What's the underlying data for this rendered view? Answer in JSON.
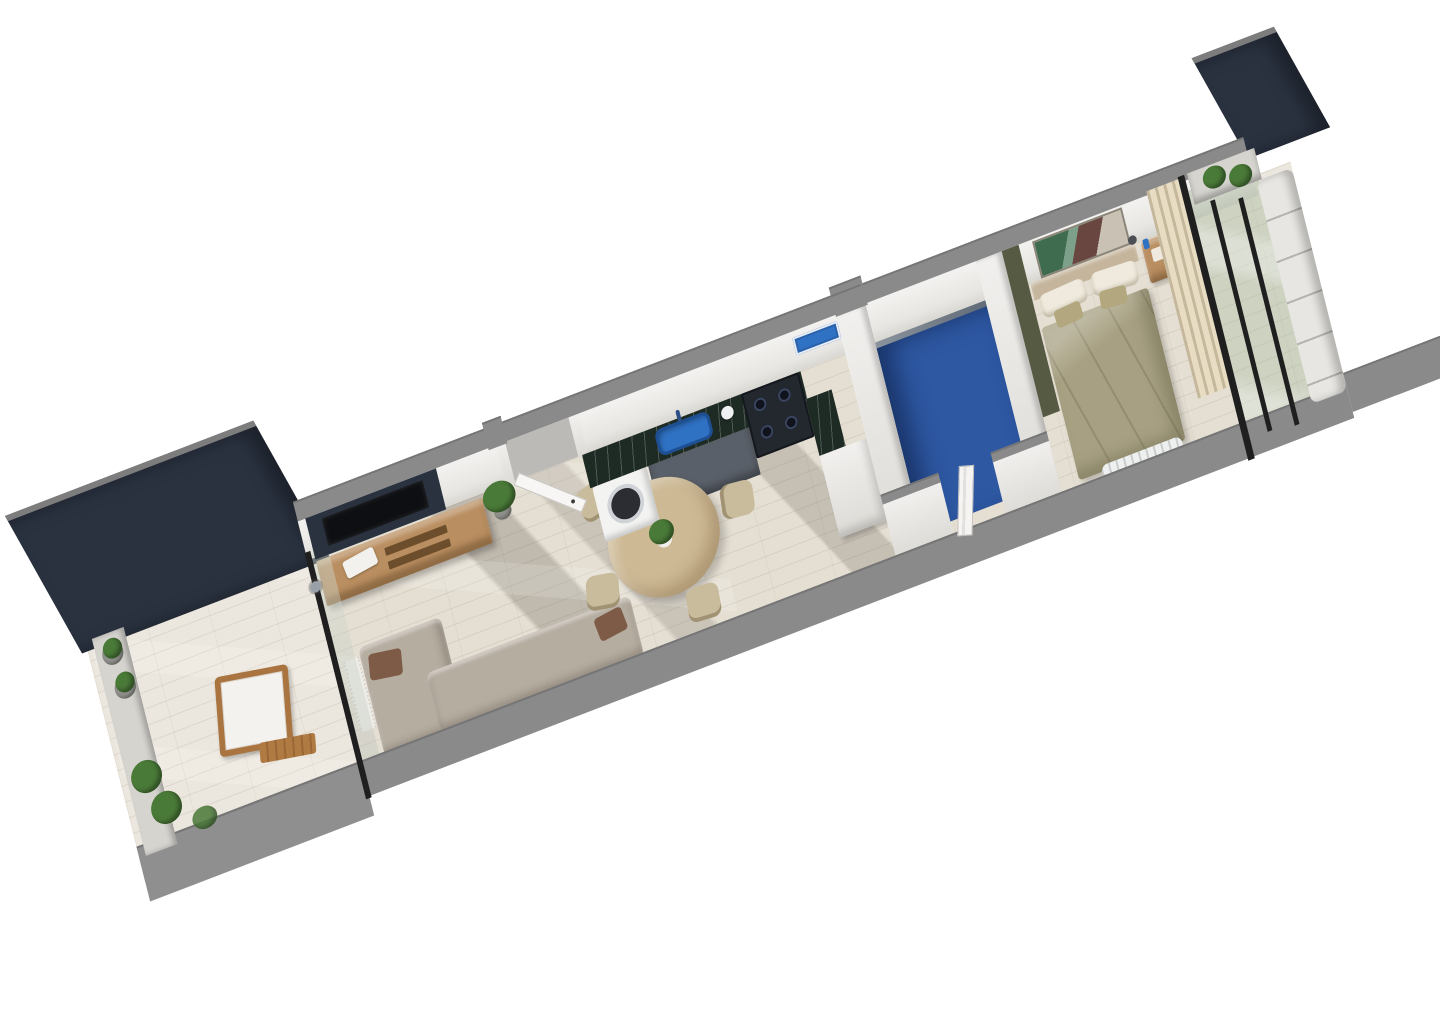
{
  "scene": {
    "type": "3d-floor-plan-render",
    "description": "Axonometric 3D render of a long narrow one-bedroom apartment with two terraces, shown diagonally on a white background",
    "background": "#ffffff",
    "rotation_deg": -21
  },
  "palette": {
    "navy": "#2a3240",
    "wall_top_gray": "#8a8a8a",
    "wall_white": "#f1f0ee",
    "floor_wood": "#e5dfd3",
    "floor_terrace": "#ece7de",
    "marble_green": "#1e2b24",
    "sink_blue": "#2f71c3",
    "tray_blue": "#2f71c3",
    "bath_floor_blue": "#2e58a2",
    "bath_wall_gray": "#76808b",
    "duvet_olive": "#a7a082",
    "headboard_tan": "#c5b59c",
    "pillow_white": "#efeadd",
    "pillow_olive": "#b2a77e",
    "wood_oak": "#b98e60",
    "wood_light": "#cdb994",
    "chair_beige": "#c9bc9d",
    "sofa_beige": "#b6ada1",
    "cushion_brown": "#7d5b46",
    "curtain_cream": "#e8ddc3",
    "glass_green": "rgba(163,181,152,0.42)",
    "frame_black": "#1f1f1f",
    "plant_green": "#4a7a38",
    "bench_white": "#e7e6e2",
    "olive_wall": "#565a43",
    "stove_black": "#23272e",
    "washer_white": "#f3f3f2",
    "cabinet_dark": "#5a6069",
    "radiator_white": "#eef0ef",
    "concrete_ledge": "#d6d4cf"
  },
  "rooms": [
    {
      "id": "terrace-west",
      "name": "west terrace",
      "items": [
        "navy accent wall",
        "concrete planter ledge",
        "potted plants",
        "wooden armchair with white cushion",
        "wooden footrest bench",
        "timber deck floor",
        "glass sliding door"
      ]
    },
    {
      "id": "living-room",
      "name": "living room",
      "items": [
        "navy tv wall",
        "wall-mounted tv",
        "oak sideboard",
        "table lamp",
        "decor tray",
        "potted plant",
        "corner sofa with brown cushions",
        "doormat",
        "entrance door",
        "wood floor",
        "sun shadows"
      ]
    },
    {
      "id": "kitchen-dining",
      "name": "kitchen and dining",
      "items": [
        "green marble countertop",
        "blue sink with faucet",
        "washing machine",
        "dark base cabinets",
        "gas range",
        "tall white cabinet",
        "blue serving tray",
        "kettle",
        "round oak dining table",
        "plant centerpiece",
        "four dining chairs"
      ]
    },
    {
      "id": "bathroom",
      "name": "bathroom",
      "items": [
        "blue tile floor",
        "gray shower wall",
        "white paneled door",
        "white partition walls"
      ]
    },
    {
      "id": "bedroom",
      "name": "bedroom",
      "items": [
        "double bed with olive duvet",
        "upholstered headboard",
        "pillows",
        "abstract wall art",
        "wooden nightstand",
        "bedside lamp",
        "olive accent wall",
        "radiator",
        "cream curtains",
        "glass partition"
      ]
    },
    {
      "id": "terrace-east",
      "name": "east terrace",
      "items": [
        "navy privacy panel",
        "planter ledge with two plants",
        "white lounge bench",
        "glass balustrade with black posts",
        "timber deck floor",
        "neighbor wall stub"
      ]
    }
  ]
}
